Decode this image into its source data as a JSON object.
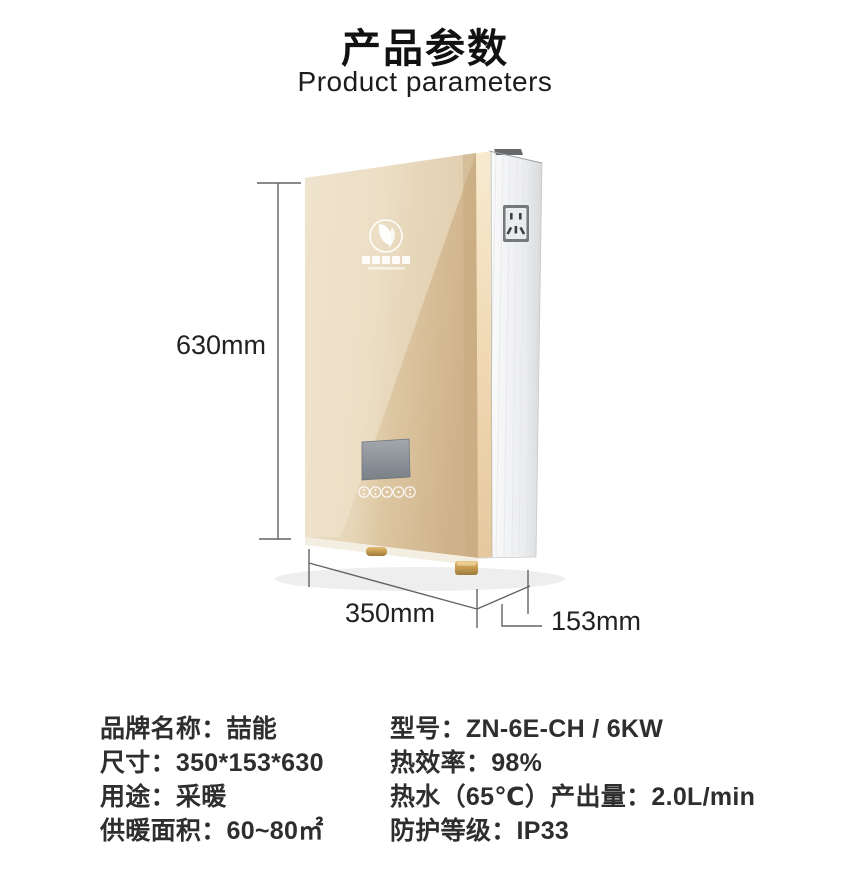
{
  "header": {
    "title": "产品参数",
    "subtitle": "Product parameters"
  },
  "figure": {
    "height_label": "630mm",
    "width_label": "350mm",
    "depth_label": "153mm",
    "device_colors": {
      "panel_gold_light": "#ecdfc6",
      "panel_gold_dark": "#cfb289",
      "trim_gold": "#f0d9b4",
      "side_silver": "#f2f3f5",
      "screen_gray": "#8b9197",
      "dimension_line": "#4a4a4a"
    }
  },
  "specs": {
    "left_lines": [
      "品牌名称：喆能",
      "尺寸：350*153*630",
      "用途：采暖",
      "供暖面积：60~80㎡"
    ],
    "right_lines": [
      "型号：ZN-6E-CH / 6KW",
      "热效率：98%",
      "热水（65℃）产出量：2.0L/min",
      "防护等级：IP33"
    ]
  }
}
